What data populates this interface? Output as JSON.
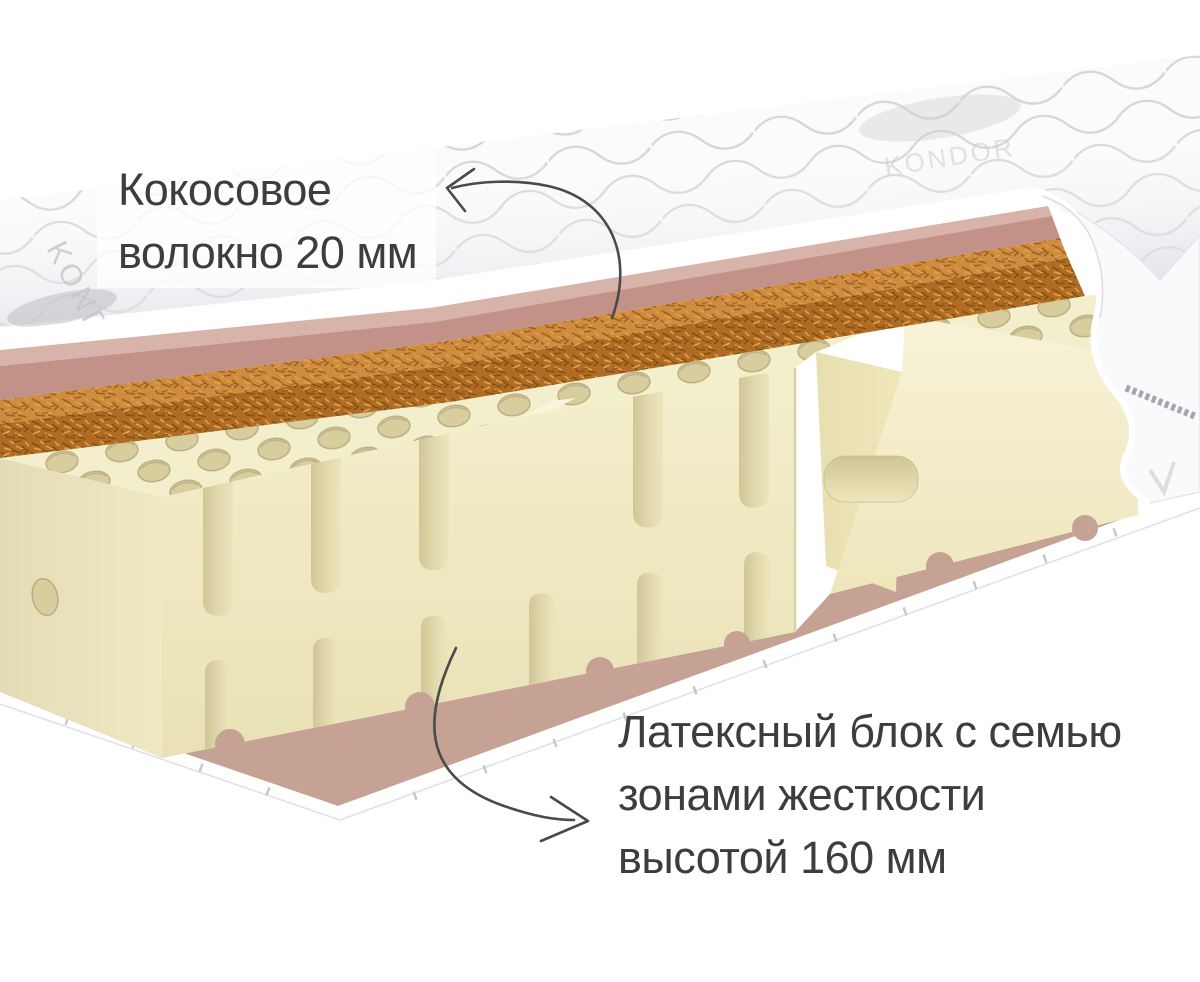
{
  "page": {
    "background": "#ffffff"
  },
  "labels": {
    "coconut": {
      "line1": "Кокосовое",
      "line2": "волокно 20 мм"
    },
    "latex": {
      "line1": "Латексный блок с семью",
      "line2": "зонами жесткости",
      "line3": "высотой 160 мм"
    }
  },
  "brand": {
    "embroidery": "KONDOR"
  },
  "colors": {
    "label_text": "#3d3d3d",
    "arrow": "#4a4a4a",
    "fabric": "#fbfbfd",
    "stitch": "#d6d6da",
    "pink_top": "#d8b3a9",
    "pink_front": "#c29187",
    "coconut_light": "#cf8c3e",
    "coconut_dark": "#b06c24",
    "latex_top": "#f3eecb",
    "latex_hole": "#d8cd9d",
    "pink_bottom": "#c5a294",
    "bottom_cover": "#ffffff"
  }
}
